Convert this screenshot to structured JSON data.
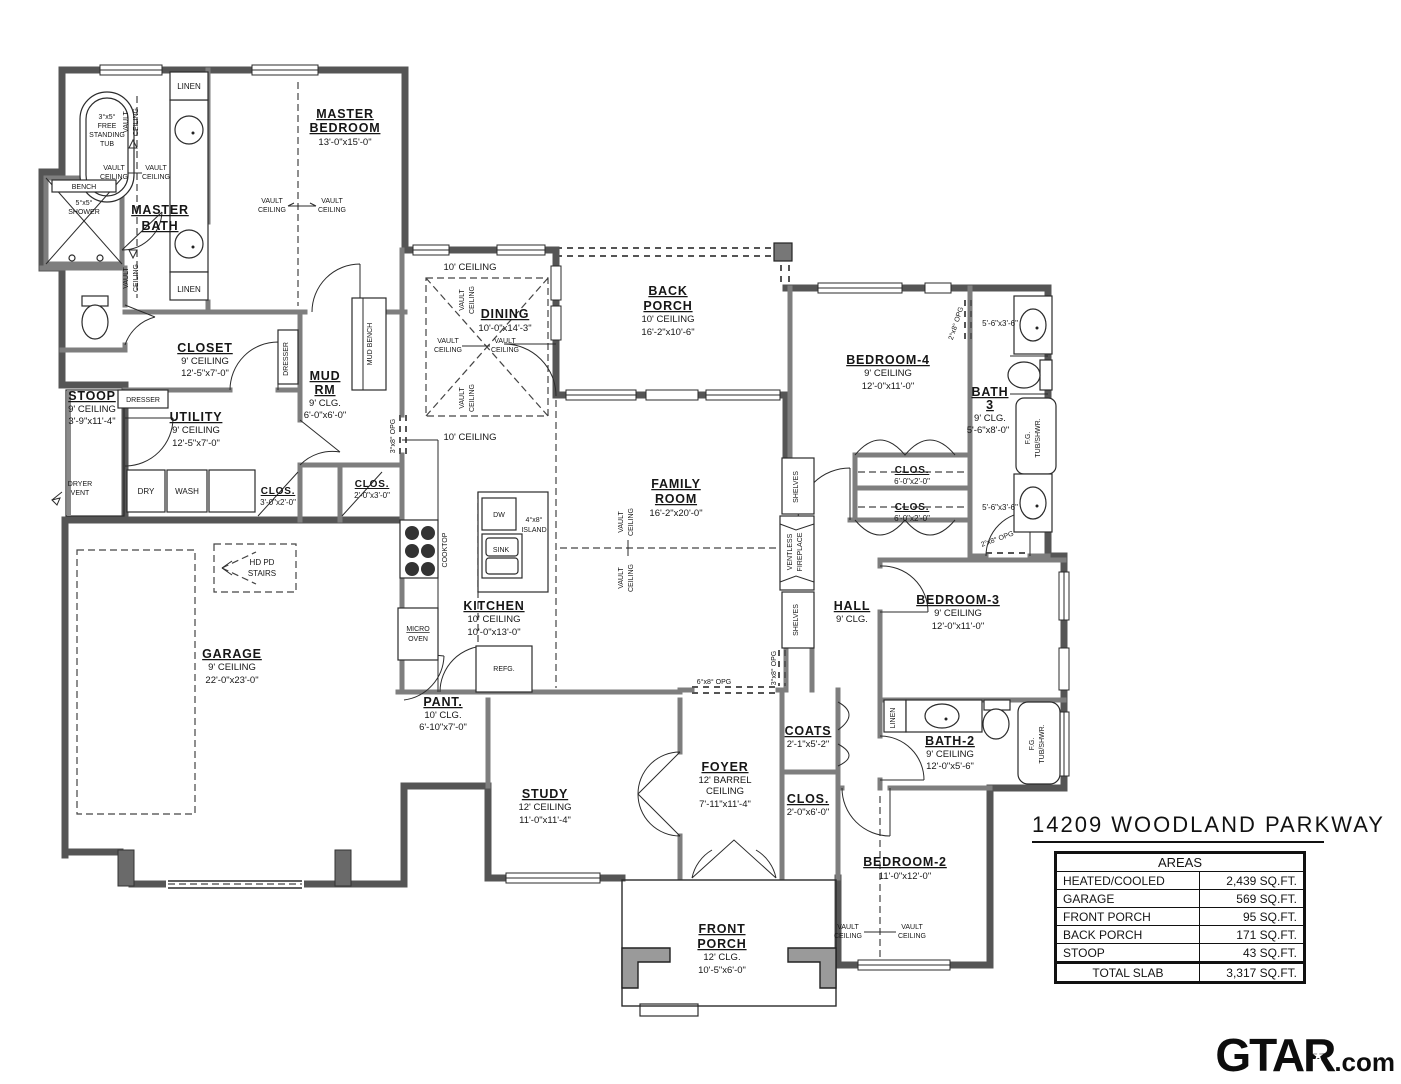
{
  "title": "14209 WOODLAND PARKWAY",
  "logo": {
    "brand": "GTAR",
    "star": "★",
    "suffix": ".com"
  },
  "areas_table": {
    "header": "AREAS",
    "rows": [
      {
        "label": "HEATED/COOLED",
        "value": "2,439 SQ.FT."
      },
      {
        "label": "GARAGE",
        "value": "569 SQ.FT."
      },
      {
        "label": "FRONT PORCH",
        "value": "95 SQ.FT."
      },
      {
        "label": "BACK PORCH",
        "value": "171 SQ.FT."
      },
      {
        "label": "STOOP",
        "value": "43 SQ.FT."
      }
    ],
    "total_label": "TOTAL SLAB",
    "total_value": "3,317 SQ.FT."
  },
  "rooms": {
    "master_bedroom": {
      "l1": "MASTER",
      "l2": "BEDROOM",
      "dims": "13'-0\"x15'-0\""
    },
    "master_bath": {
      "l1": "MASTER",
      "l2": "BATH"
    },
    "closet": {
      "l1": "CLOSET",
      "ceil": "9' CEILING",
      "dims": "12'-5\"x7'-0\""
    },
    "stoop": {
      "l1": "STOOP",
      "ceil": "9' CEILING",
      "dims": "3'-9\"x11'-4\""
    },
    "utility": {
      "l1": "UTILITY",
      "ceil": "9' CEILING",
      "dims": "12'-5\"x7'-0\""
    },
    "mud": {
      "l1": "MUD",
      "l2": "RM",
      "ceil": "9' CLG.",
      "dims": "6'-0\"x6'-0\""
    },
    "dining": {
      "l1": "DINING",
      "dims": "10'-0\"x14'-3\""
    },
    "back_porch": {
      "l1": "BACK",
      "l2": "PORCH",
      "ceil": "10' CEILING",
      "dims": "16'-2\"x10'-6\""
    },
    "bedroom4": {
      "l1": "BEDROOM-4",
      "ceil": "9' CEILING",
      "dims": "12'-0\"x11'-0\""
    },
    "bath3": {
      "l1": "BATH",
      "l2": "3",
      "ceil": "9' CLG.",
      "dims": "5'-6\"x8'-0\""
    },
    "family": {
      "l1": "FAMILY",
      "l2": "ROOM",
      "dims": "16'-2\"x20'-0\""
    },
    "kitchen": {
      "l1": "KITCHEN",
      "ceil": "10' CEILING",
      "dims": "10'-0\"x13'-0\""
    },
    "garage": {
      "l1": "GARAGE",
      "ceil": "9' CEILING",
      "dims": "22'-0\"x23'-0\""
    },
    "hall": {
      "l1": "HALL",
      "ceil": "9' CLG."
    },
    "bedroom3": {
      "l1": "BEDROOM-3",
      "ceil": "9' CEILING",
      "dims": "12'-0\"x11'-0\""
    },
    "pantry": {
      "l1": "PANT.",
      "ceil": "10' CLG.",
      "dims": "6'-10\"x7'-0\""
    },
    "study": {
      "l1": "STUDY",
      "ceil": "12' CEILING",
      "dims": "11'-0\"x11'-4\""
    },
    "foyer": {
      "l1": "FOYER",
      "ceil1": "12' BARREL",
      "ceil2": "CEILING",
      "dims": "7'-11\"x11'-4\""
    },
    "coats": {
      "l1": "COATS",
      "dims": "2'-1\"x5'-2\""
    },
    "clos_foyer": {
      "l1": "CLOS.",
      "dims": "2'-0\"x6'-0\""
    },
    "bath2": {
      "l1": "BATH-2",
      "ceil": "9' CEILING",
      "dims": "12'-0\"x5'-6\""
    },
    "bedroom2": {
      "l1": "BEDROOM-2",
      "dims": "11'-0\"x12'-0\""
    },
    "front_porch": {
      "l1": "FRONT",
      "l2": "PORCH",
      "ceil": "12' CLG.",
      "dims": "10'-5\"x6'-0\""
    },
    "clos_utility": {
      "l1": "CLOS.",
      "dims": "3'-0\"x2'-0\""
    },
    "clos_mud": {
      "l1": "CLOS.",
      "dims": "2'-0\"x3'-0\""
    },
    "clos_bed4a": {
      "l1": "CLOS.",
      "dims": "6'-0\"x2'-0\""
    },
    "clos_bed4b": {
      "l1": "CLOS.",
      "dims": "6'-0\"x2'-0\""
    }
  },
  "fixtures": {
    "tub_size": "3°x5°",
    "tub1": "FREE",
    "tub2": "STANDING",
    "tub3": "TUB",
    "bench": "BENCH",
    "shower_size": "5°x5°",
    "shower": "SHOWER",
    "linen": "LINEN",
    "dresser": "DRESSER",
    "mud_bench": "MUD BENCH",
    "dry": "DRY",
    "wash": "WASH",
    "dryer1": "DRYER",
    "dryer2": "VENT",
    "stairs1": "HD PD",
    "stairs2": "STAIRS",
    "cooktop": "COOKTOP",
    "micro1": "MICRO",
    "micro2": "OVEN",
    "dw": "DW",
    "sink": "SINK",
    "island1": "4°x8°",
    "island2": "ISLAND",
    "refg": "REFG.",
    "shelves": "SHELVES",
    "fp1": "VENTLESS",
    "fp2": "FIREPLACE",
    "fg1": "F.G.",
    "fg2": "TUB/SHWR.",
    "vanity36": "5'-6\"x3'-6\""
  },
  "notes": {
    "vault": "VAULT",
    "ceiling": "CEILING",
    "ceil10": "10' CEILING",
    "opg3": "3°x8° OPG",
    "opg6": "6°x8° OPG",
    "opg2": "2°x8° OPG"
  }
}
